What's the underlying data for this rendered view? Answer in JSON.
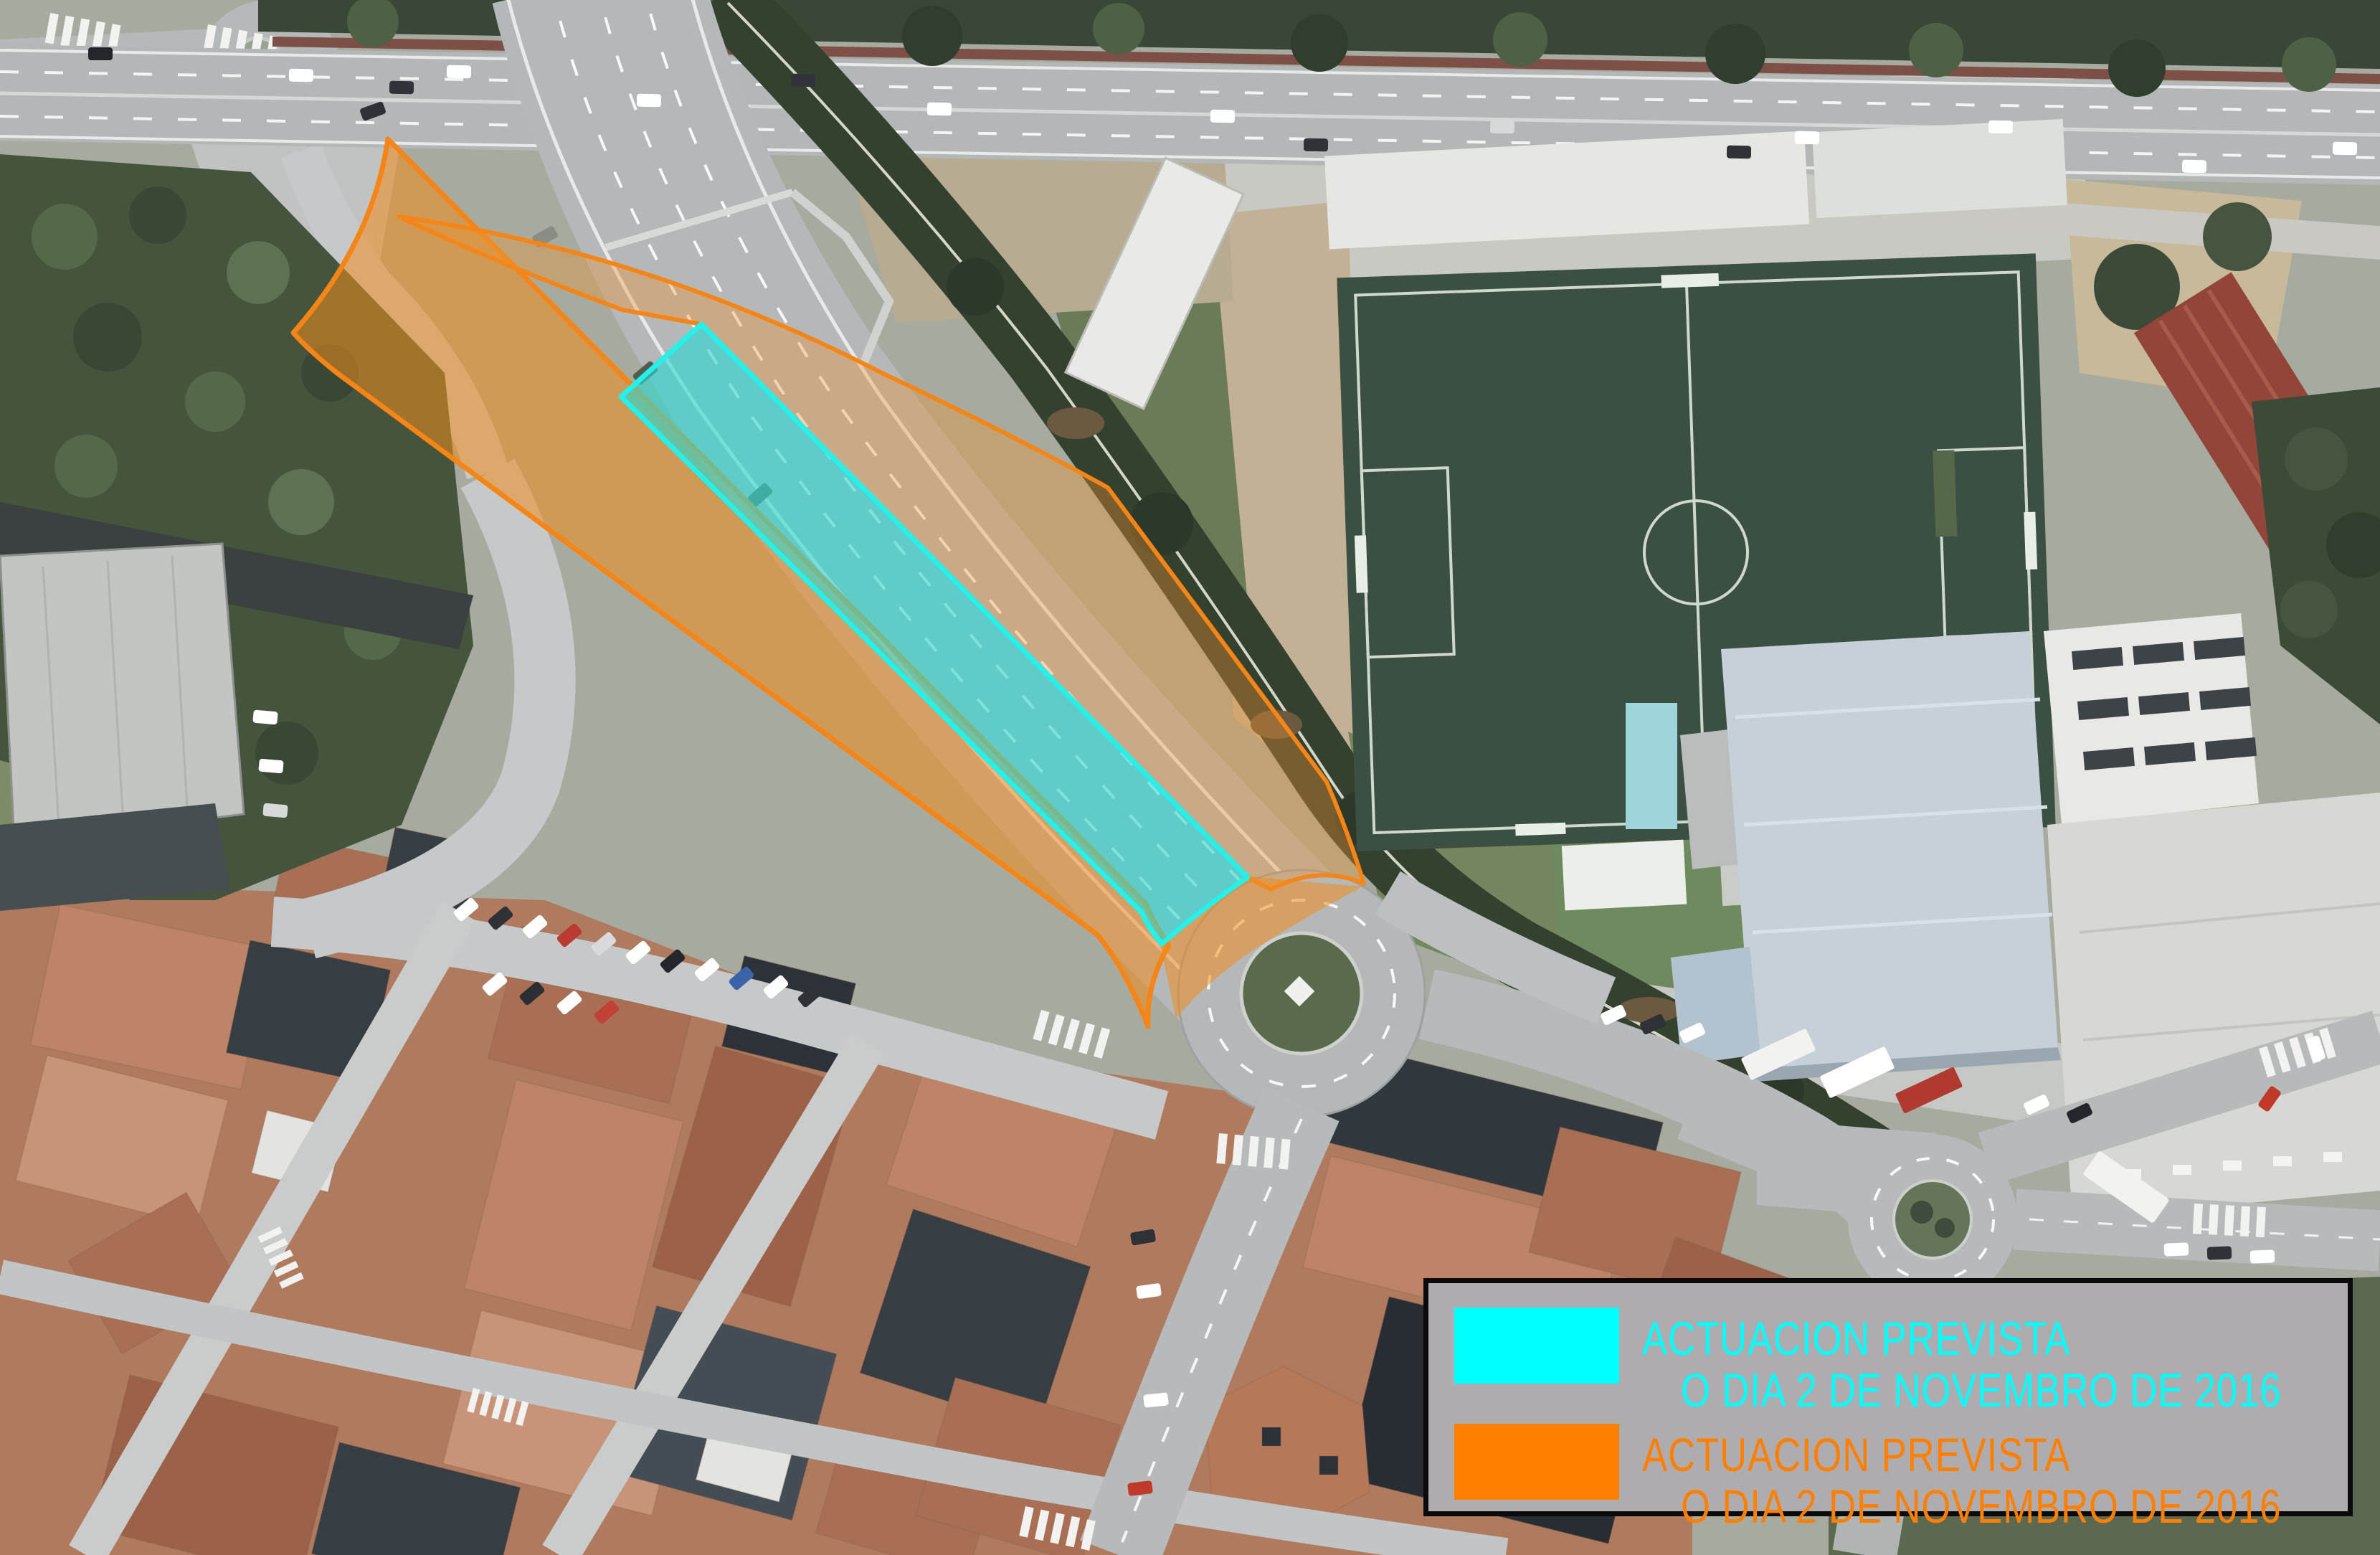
{
  "legend": {
    "background_color": "#AEACAE",
    "entries": [
      {
        "id": "cyan",
        "color": "#00FFFF",
        "line1": "ACTUACION PREVISTA",
        "line2": "O DIA 2 DE NOVEMBRO DE 2016"
      },
      {
        "id": "orange",
        "color": "#FF8000",
        "line1": "ACTUACION PREVISTA",
        "line2": "O DIA 2 DE NOVEMBRO DE 2016"
      }
    ]
  },
  "overlays": {
    "cyan_zone_color": "#00FFFF",
    "orange_zone_color": "#FF8000"
  }
}
